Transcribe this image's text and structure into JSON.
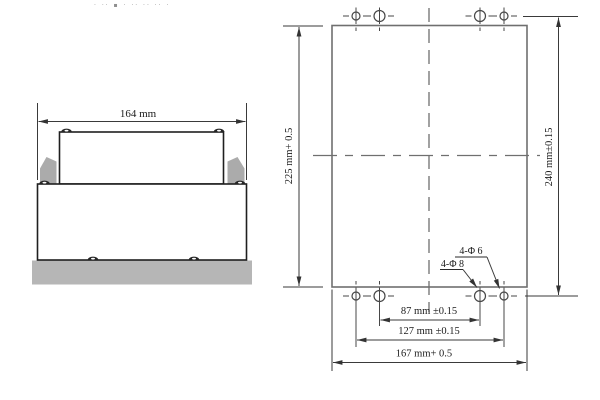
{
  "colors": {
    "bg": "#ffffff",
    "ink": "#1f1f1f",
    "panel": "#6f6f6f",
    "dim": "#3a3a3a",
    "clip": "#ababab",
    "base": "#b6b6b6"
  },
  "header": {
    "marks": "· ·· ▪ · ·· ·· ·· · ·"
  },
  "side_view": {
    "width_dim": "164 mm"
  },
  "panel_view": {
    "dim_left": "225 mm+ 0.5",
    "dim_right": "240 mm±0.15",
    "label_holes_small": "4-Φ 6",
    "label_holes_large": "4-Φ 8",
    "dim_inner_span": "87 mm ±0.15",
    "dim_outer_span": "127 mm ±0.15",
    "dim_total_span": "167 mm+ 0.5"
  }
}
